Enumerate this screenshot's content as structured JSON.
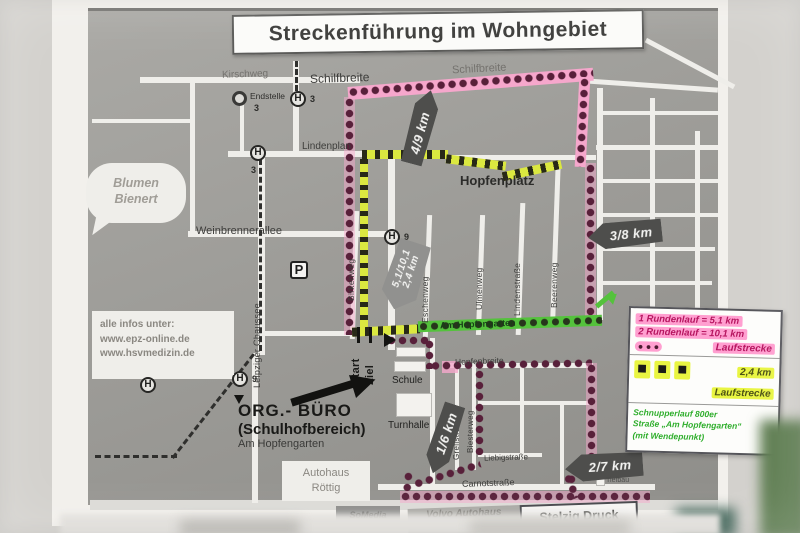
{
  "title": "Streckenführung im Wohngebiet",
  "info_box": {
    "heading": "alle infos unter:",
    "url1": "www.epz-online.de",
    "url2": "www.hsvmedizin.de"
  },
  "bubble": {
    "line1": "Blumen",
    "line2": "Bienert"
  },
  "legend": {
    "round1": "1 Rundenlauf = 5,1 km",
    "round2": "2 Rundenlauf = 10,1 km",
    "dots": "●  ●  ●",
    "pink_label": "Laufstrecke",
    "square": "■",
    "yellow_km": "2,4 km",
    "yellow_label": "Laufstrecke",
    "green1": "Schnupperlauf 800er",
    "green2": "Straße „Am Hopfengarten“",
    "green3": "(mit Wendepunkt)"
  },
  "markers": {
    "km49": "4/9 km",
    "km38": "3/8 km",
    "km16": "1/6 km",
    "km27": "2/7 km",
    "start_banner1": "5,1/10,1",
    "start_banner2": "2,4 km"
  },
  "streets": {
    "kirschweg": "Kirschweg",
    "schilfbreite": "Schilfbreite",
    "schilfbreite2": "Schilfbreite",
    "lindenplan": "Lindenplan",
    "hopfenplatz": "Hopfenplatz",
    "weinbrennerallee": "Weinbrennerallee",
    "leipziger_chaussee": "Leipziger Chaussee",
    "birkenweg": "Birkenweg",
    "eschenweg": "Eschenweg",
    "ulmenweg": "Ulmenweg",
    "lindenstrasse": "Lindenstraße",
    "beerenweg": "Beerenweg",
    "am_hopfengarten": "Am Hopfengarten",
    "hopfenbreite": "Hopfenbreite",
    "grellstrasse": "Grellstraße",
    "biesterweg": "Biesterweg",
    "liebigstrasse": "Liebigstraße",
    "carnotstrasse": "Carnotstraße"
  },
  "transit": {
    "endstelle": "Endstelle",
    "line3": "3",
    "line9": "9",
    "parking": "P"
  },
  "places": {
    "schule": "Schule",
    "turnhalle": "Turnhalle",
    "start": "Start",
    "ziel": "Ziel",
    "org1": "ORG.- BÜRO",
    "org2": "(Schulhofbereich)",
    "org3": "Am Hopfengarten",
    "autohaus1": "Autohaus",
    "autohaus2": "Röttig",
    "volvo": "Volvo Autohaus",
    "somedia": "SoMedia",
    "stelzig": "Stelzig Druck",
    "tiefbau": "Tiefbau"
  }
}
